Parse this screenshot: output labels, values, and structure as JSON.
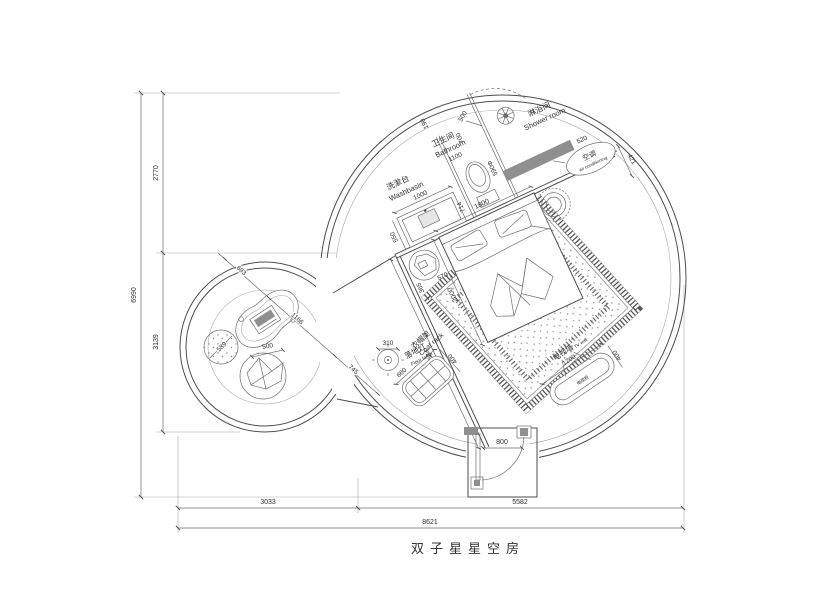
{
  "title": "双子星星空房",
  "colors": {
    "line": "#4d4d4d",
    "line_light": "#a9a9a9",
    "text": "#2e2e2e",
    "dark_fill": "#8f8f8f",
    "paper": "#ffffff"
  },
  "areas": {
    "washbasin": {
      "cn": "洗漱台",
      "en": "Washbasin",
      "width": "1000",
      "depth": "550",
      "gap": "714"
    },
    "bathroom": {
      "cn": "卫生间",
      "en": "Bathroom",
      "width": "1100",
      "dim_a": "190",
      "dim_b": "700",
      "toilet_dia": "590Φ"
    },
    "shower": {
      "cn": "淋浴间",
      "en": "Shower room",
      "door": "500",
      "wall": "520"
    },
    "ac": {
      "cn": "空调",
      "en": "air conditioning",
      "offset": "421"
    },
    "bed": {
      "width": "1800",
      "length": "2000",
      "side_a": "365",
      "side_b": "570"
    },
    "tv": {
      "cn": "电视墙",
      "en": "TV wall",
      "cabinet": "电视柜",
      "width": "1200",
      "depth": "400"
    },
    "coat_rack": {
      "cn": "衣帽架",
      "en": "Coat rack",
      "width": "660",
      "depth": "400"
    },
    "floor_lamp": {
      "cn": "落地灯",
      "en": "Floor lamp",
      "dia": "310"
    },
    "desk": {
      "dim_a": "693",
      "dim_b": "1166",
      "dim_c": "745"
    },
    "pouf": {
      "dia": "589"
    },
    "cushion": {
      "dia": "500"
    },
    "door": {
      "width": "800"
    },
    "wall": {
      "diag": "5684"
    }
  },
  "dimensions": {
    "overall_w": "8621",
    "bottom_left": "3033",
    "bottom_right": "5582",
    "overall_h": "6990",
    "left_top": "2770",
    "left_bottom": "3139"
  }
}
